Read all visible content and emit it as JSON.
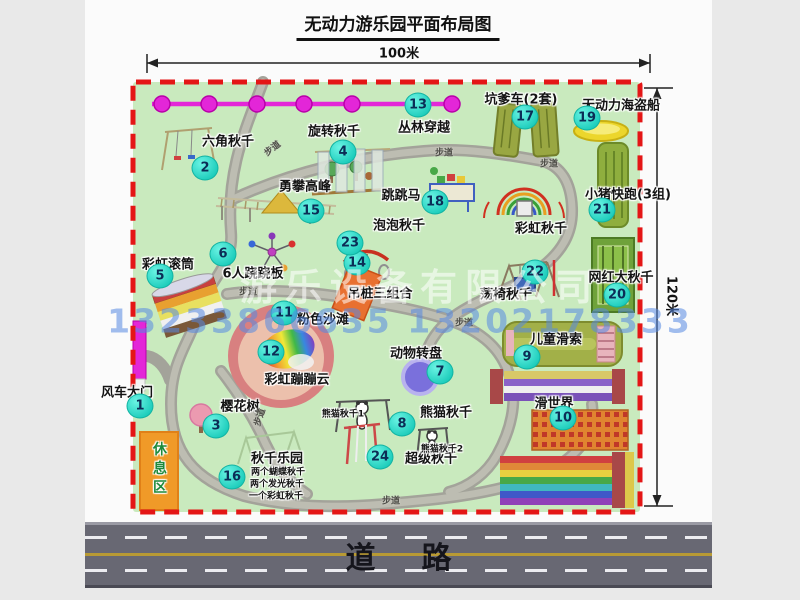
{
  "title": "无动力游乐园平面布局图",
  "dims": {
    "width": "100米",
    "height": "120米"
  },
  "road": {
    "label": "道路"
  },
  "rest_area": {
    "label": "休息区"
  },
  "walkway": {
    "label": "步道"
  },
  "watermark": {
    "company": "游乐设备有限公司",
    "phone": "13233866635 13202178333"
  },
  "extra": {
    "rainbow_swing": "彩虹秋千",
    "panda1": "熊猫秋千1",
    "panda2": "熊猫秋千2",
    "swing_items": [
      "两个蝴蝶秋千",
      "两个发光秋千",
      "一个彩虹秋千"
    ]
  },
  "colors": {
    "park_green": "#c9eabe",
    "border_red": "#e41616",
    "circle_teal": "#1ecdbc",
    "zipline_magenta": "#e326d8",
    "road_gray": "#686873",
    "rest_orange": "#f09a28"
  },
  "facilities": [
    {
      "num": "1",
      "label": "风车大门"
    },
    {
      "num": "2",
      "label": "六角秋千"
    },
    {
      "num": "3",
      "label": "樱花树"
    },
    {
      "num": "4",
      "label": "旋转秋千"
    },
    {
      "num": "5",
      "label": "彩虹滚筒"
    },
    {
      "num": "6",
      "label": "6人跷跷板"
    },
    {
      "num": "7",
      "label": "动物转盘"
    },
    {
      "num": "8",
      "label": "熊猫秋千"
    },
    {
      "num": "9",
      "label": "儿童滑索"
    },
    {
      "num": "10",
      "label": "滑世界"
    },
    {
      "num": "11",
      "label": "粉色沙滩"
    },
    {
      "num": "12",
      "label": "彩虹蹦蹦云"
    },
    {
      "num": "13",
      "label": "丛林穿越"
    },
    {
      "num": "14",
      "label": "吊桩三组合"
    },
    {
      "num": "15",
      "label": "勇攀高峰"
    },
    {
      "num": "16",
      "label": "秋千乐园"
    },
    {
      "num": "17",
      "label": "坑爹车(2套)"
    },
    {
      "num": "18",
      "label": "跳跳马"
    },
    {
      "num": "19",
      "label": "无动力海盗船"
    },
    {
      "num": "20",
      "label": "网红大秋千"
    },
    {
      "num": "21",
      "label": "小猪快跑(3组)"
    },
    {
      "num": "22",
      "label": "荡椅秋千"
    },
    {
      "num": "23",
      "label": "泡泡秋千"
    },
    {
      "num": "24",
      "label": "超级秋千"
    }
  ]
}
